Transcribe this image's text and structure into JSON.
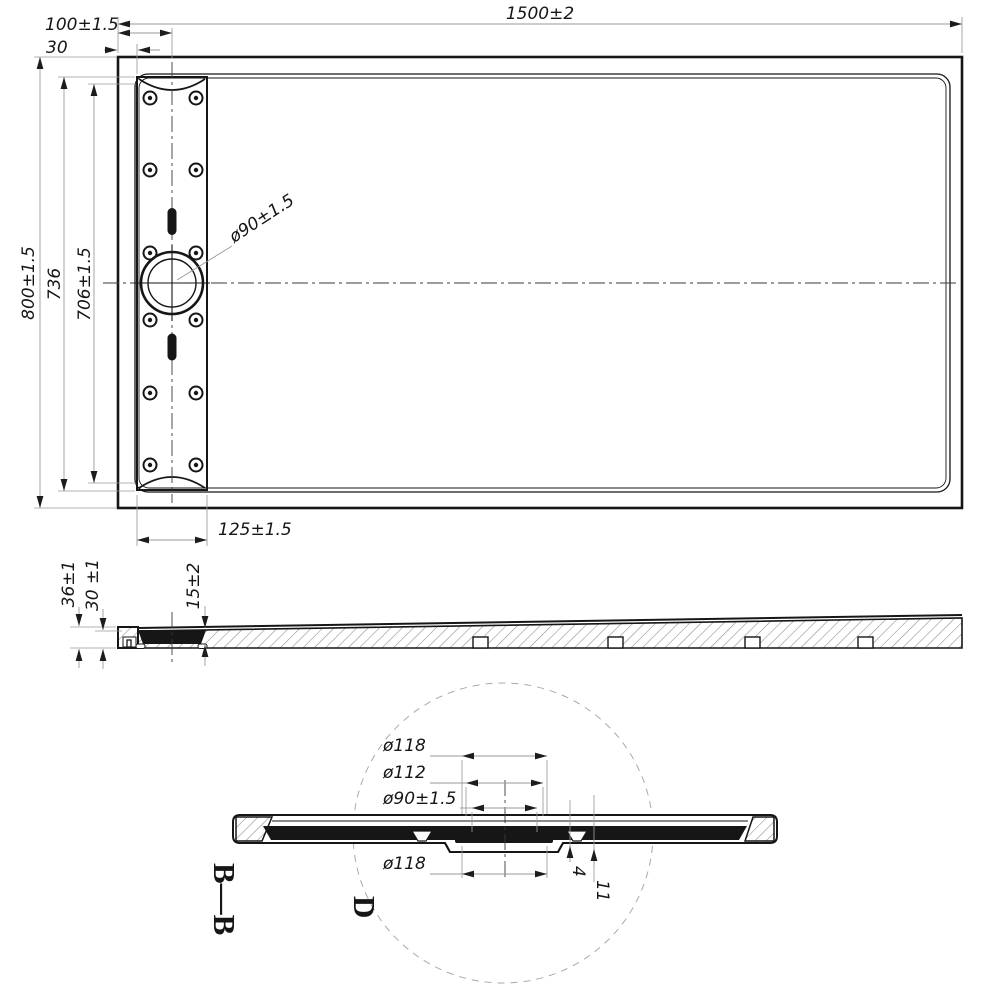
{
  "drawing": {
    "type": "technical-drawing",
    "subject": "rectangular shower tray with linear drain channel",
    "line_color": "#161616",
    "dim_line_color": "#9a9a9a",
    "background": "#ffffff"
  },
  "labels": {
    "top": {
      "overall_width": "1500±2",
      "drain_center_offset": "100±1.5",
      "edge_gap": "30",
      "overall_depth": "800±1.5",
      "channel_length_outer": "736",
      "channel_length_inner": "706±1.5",
      "drain_diameter": "ø90±1.5",
      "channel_width": "125±1.5"
    },
    "section": {
      "total_height": "36±1",
      "body_height": "30 ±1",
      "recess_depth": "15±2"
    },
    "detail": {
      "section_label": "B—B",
      "detail_label": "D",
      "dia_top": "ø118",
      "dia_mid": "ø112",
      "dia_drain": "ø90±1.5",
      "dia_bottom": "ø118",
      "step_small": "4",
      "step_large": "11"
    }
  }
}
